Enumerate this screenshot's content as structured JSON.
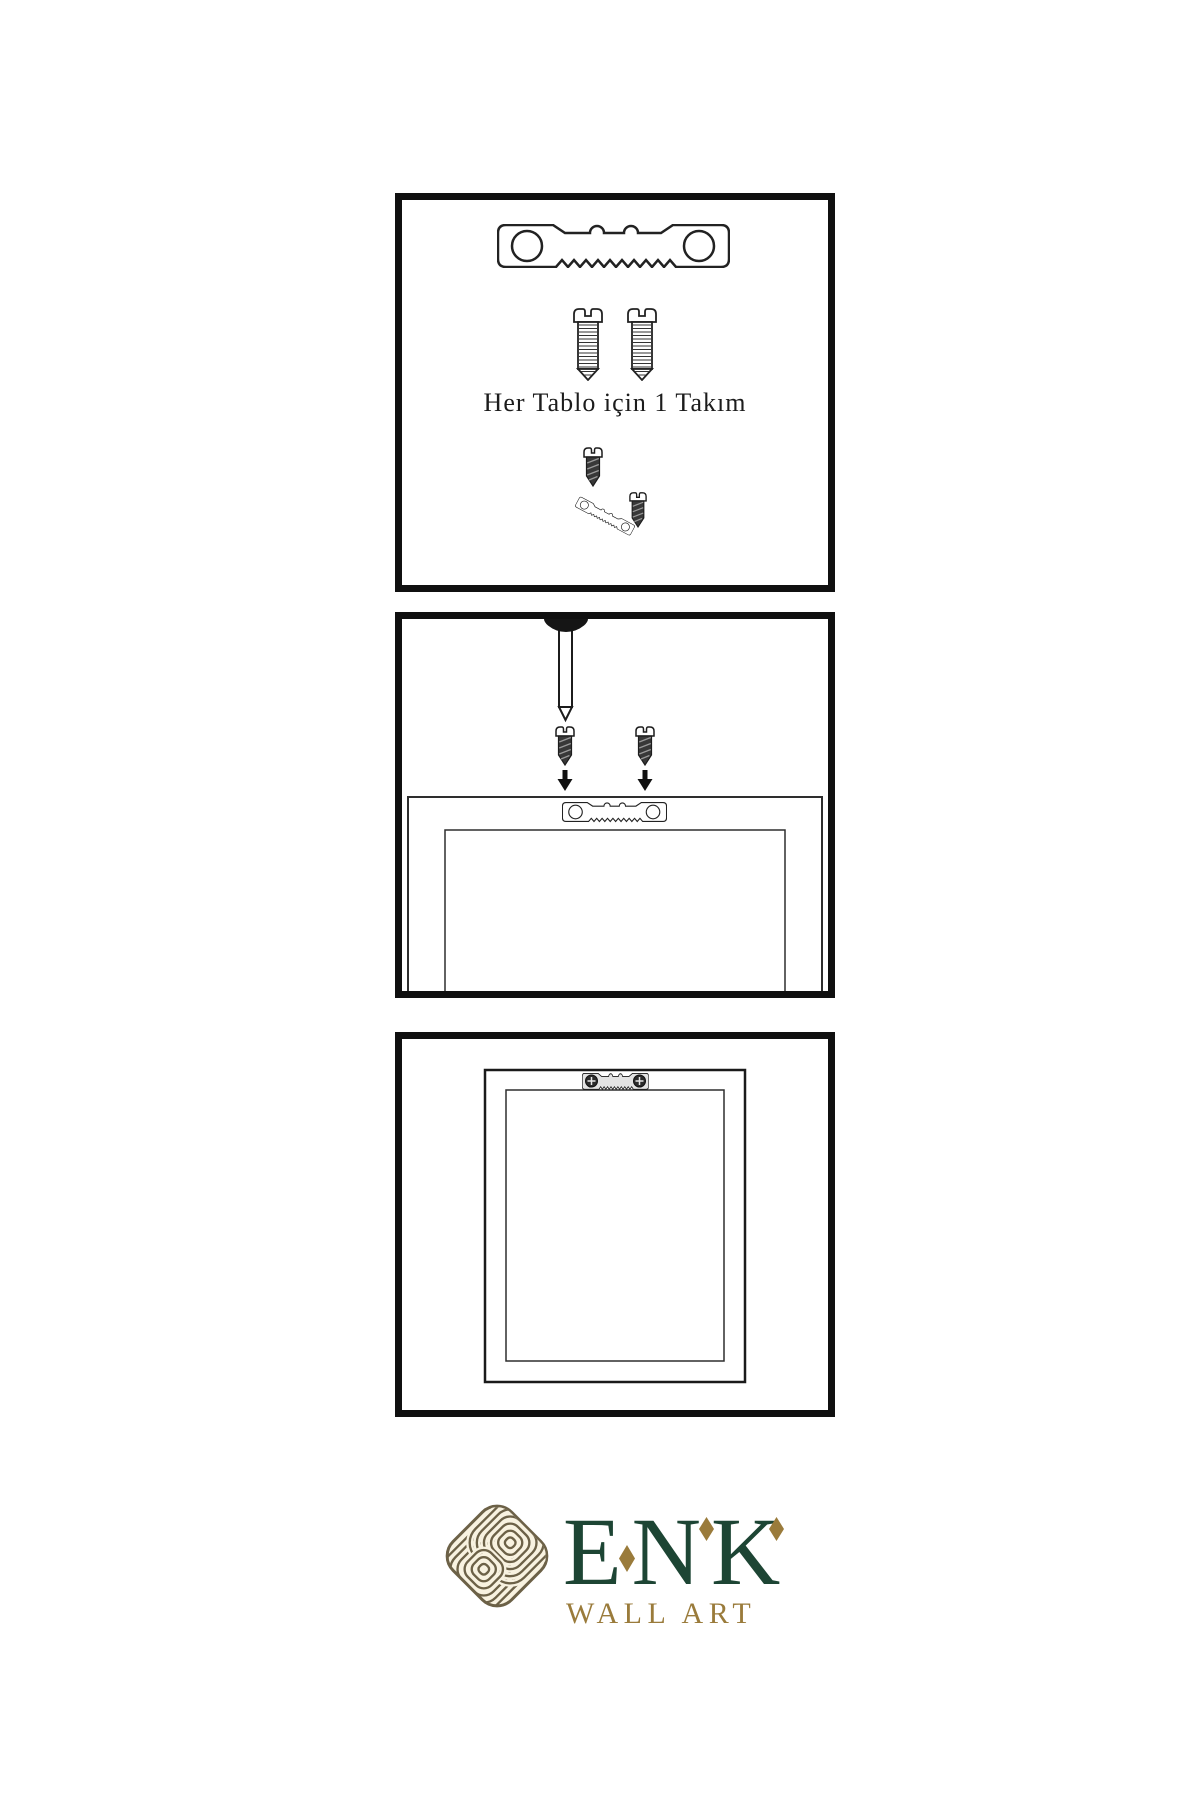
{
  "document": {
    "type": "wall-art-hanging-instructions",
    "language": "Turkish"
  },
  "steps": {
    "step1": {
      "caption": "Her Tablo için 1 Takım",
      "icons": [
        "sawtooth-hanger-icon",
        "screw-icon",
        "screw-icon",
        "screw-into-hanger-icon"
      ]
    },
    "step2": {
      "icons": [
        "wall-nail-icon",
        "dark-screw-icon",
        "dark-screw-icon",
        "down-arrow-icon",
        "down-arrow-icon",
        "frame-back-with-sawtooth-hanger-icon"
      ]
    },
    "step3": {
      "icons": [
        "hung-frame-front-with-mounted-hanger-icon"
      ]
    }
  },
  "brand": {
    "name": "ENK",
    "tagline": "WALL ART",
    "logo_icon": "interlocked-knot-icon",
    "colors": {
      "green": "#1d4534",
      "gold": "#9a7b3b",
      "knot_line": "#6c6147",
      "knot_fill": "#f8f2e0",
      "ink": "#111111"
    }
  }
}
